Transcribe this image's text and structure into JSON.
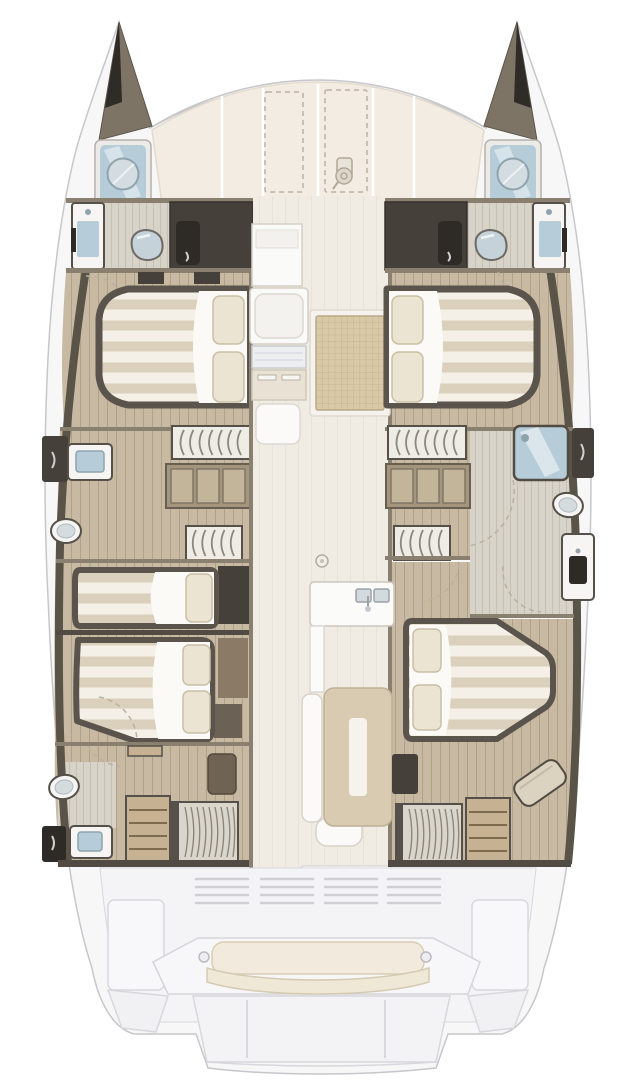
{
  "diagram": {
    "type": "boat-floor-plan",
    "subject": "sailing catamaran deck layout, top-down view",
    "hulls": 2,
    "background": "#ffffff"
  },
  "palette": {
    "background": "#ffffff",
    "hull_fill": "#f7f7f8",
    "hull_line": "#c7c7cb",
    "deck_cream": "#f3ece2",
    "deck_seam": "#ffffff",
    "bow_dark": "#7d7466",
    "bow_tip": "#2f2b27",
    "wall_taupe": "#8a8070",
    "wall_band": "#5a5348",
    "wall_dark": "#514b43",
    "charcoal": "#454039",
    "door_dark": "#2e2b27",
    "wood": "#c8baa2",
    "wood_line": "#b1a287",
    "wood_light": "#d8d3c8",
    "wood_light_line": "#c6c0b2",
    "fixture_white": "#f6f5f3",
    "fixture_line": "#55504a",
    "water_blue": "#b6ccd9",
    "blue_trim": "#8fa3ad",
    "mattress": "#f4f0e7",
    "mattress_stripe": "#dad0bb",
    "bed_dark": "#5a544c",
    "pillow": "#ece4d2",
    "pillow_line": "#c9bfa7",
    "grid_tan": "#d9c9a7",
    "grid_line": "#c0af8d",
    "saloon_floor": "#f1ece3",
    "saloon_line": "#e8e2d7",
    "table_tan": "#d8cbb2",
    "bench_cream": "#f2ebdd",
    "stair_tread": "#c6b292",
    "stair_arc": "#8d877b",
    "aft_deck": "#f4f4f6",
    "aft_line": "#d8d8dc",
    "dashed": "#b9b1a3"
  },
  "areas": {
    "foredeck": {
      "sun_panels": 5,
      "dashed_hatches": 2,
      "icon": "windlass-icon"
    },
    "port_bow": {
      "item": "porthole-hatch"
    },
    "starboard_bow": {
      "item": "porthole-hatch"
    },
    "port_hull": {
      "rooms": [
        "forward-head",
        "forward-cabin",
        "mid-head",
        "companionway",
        "aft-cabin-forward",
        "aft-cabin",
        "aft-head"
      ],
      "beds": 3,
      "toilets": 2,
      "sinks": 3,
      "showers": 1,
      "stairs": 3,
      "wardrobes": 3
    },
    "starboard_hull": {
      "rooms": [
        "forward-head",
        "forward-cabin",
        "mid-bathroom",
        "companionway",
        "aft-cabin",
        "aft-companionway"
      ],
      "beds": 2,
      "toilets": 1,
      "sinks": 2,
      "showers": 2,
      "stairs": 3,
      "wardrobes": 3,
      "seats": 1
    },
    "saloon": {
      "forward_units": [
        "chart-module",
        "seat-module",
        "galley-module"
      ],
      "floor_hatch": "grid-hatch",
      "galley_sinks": 2,
      "dinette": [
        "bench",
        "table"
      ],
      "aft_door": 1
    },
    "aft_cockpit": {
      "vent_groups": 4,
      "bench": "transom-bench",
      "swim_platform": 1
    }
  }
}
